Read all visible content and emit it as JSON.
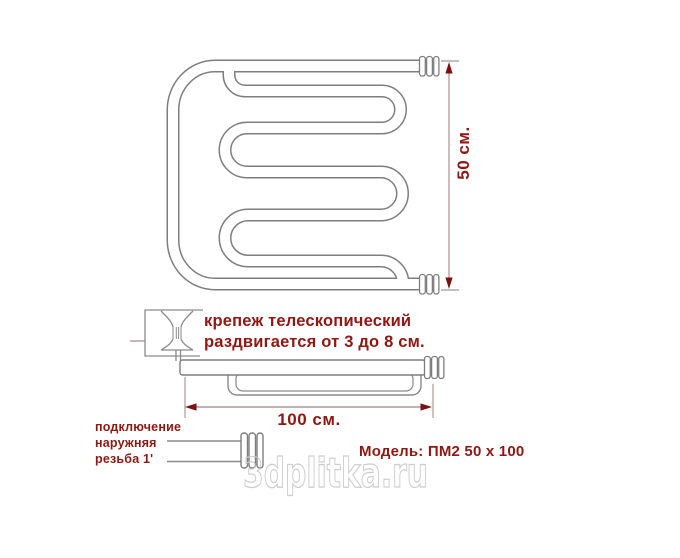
{
  "drawing": {
    "height_dimension_label": "50 см.",
    "width_dimension_label": "100 см."
  },
  "annotations": {
    "fastener_note_line1": "крепеж телескопический",
    "fastener_note_line2": "раздвигается от 3 до 8 см.",
    "connection_note_line1": "подключение",
    "connection_note_line2": "наружняя",
    "connection_note_line3": "резьба 1'",
    "model_label": "Модель: ПМ2 50 х 100"
  },
  "watermark": {
    "text": "3dplitka.ru"
  },
  "colors": {
    "tube_line_gray": "#7e7e7e",
    "detail_line_gray": "#8a8a8a",
    "dimension_line": "#ab9090",
    "arrow_red": "#7c100e",
    "label_red": "#8f1812",
    "watermark_gray": "#c9c9c9"
  }
}
